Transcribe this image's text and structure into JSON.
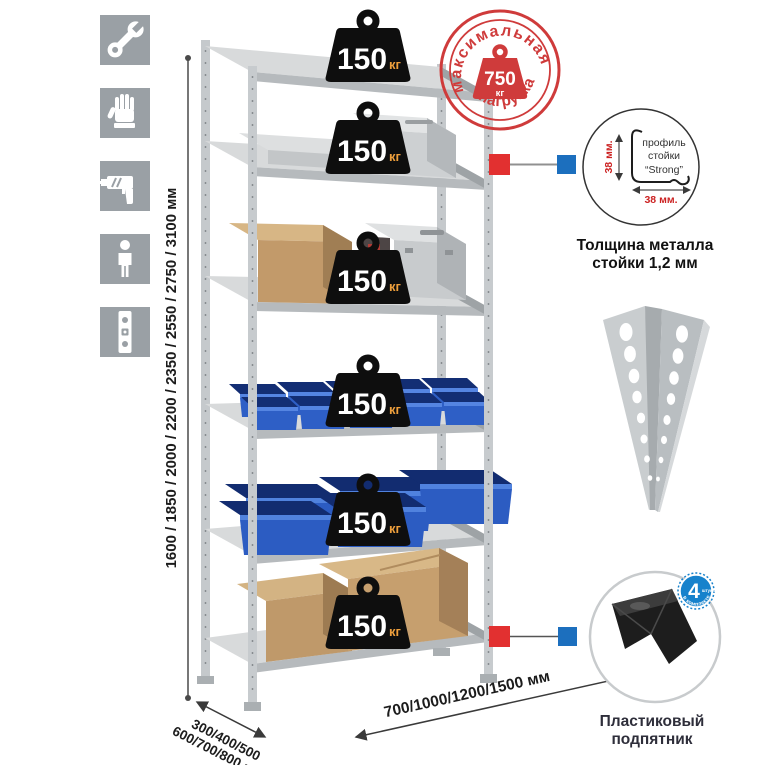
{
  "icons": [
    {
      "name": "wrench-icon"
    },
    {
      "name": "gloves-icon"
    },
    {
      "name": "drill-icon"
    },
    {
      "name": "person-icon"
    },
    {
      "name": "spirit-level-icon"
    }
  ],
  "height_dim": {
    "label": "1600 / 1850 / 2000 / 2200 / 2350 / 2550 / 2750 / 3100 мм"
  },
  "depth_dim": {
    "line1": "300/400/500",
    "line2": "600/700/800 мм"
  },
  "width_dim": {
    "label": "700/1000/1200/1500 мм"
  },
  "shelves": [
    {
      "load": "150",
      "unit": "кг"
    },
    {
      "load": "150",
      "unit": "кг"
    },
    {
      "load": "150",
      "unit": "кг"
    },
    {
      "load": "150",
      "unit": "кг"
    },
    {
      "load": "150",
      "unit": "кг"
    },
    {
      "load": "150",
      "unit": "кг"
    }
  ],
  "max_load_stamp": {
    "arc_top": "максимальная",
    "arc_bottom": "нагрузка",
    "value": "750",
    "unit": "кг"
  },
  "post_profile": {
    "label_line1": "профиль",
    "label_line2": "стойки",
    "label_line3": "“Strong”",
    "dim_height": "38 мм.",
    "dim_width": "38 мм.",
    "caption_line1": "Толщина металла",
    "caption_line2": "стойки 1,2 мм"
  },
  "foot": {
    "badge_value": "4",
    "badge_note": "штуки",
    "badge_arc": "в комплекте",
    "caption_line1": "Пластиковый",
    "caption_line2": "подпятник"
  },
  "colors": {
    "stamp_red": "#cf3b3b",
    "marker_red": "#e23030",
    "marker_blue": "#1c6fbe",
    "bin_blue": "#2e5fc6",
    "weight_badge_black": "#0e0e0e",
    "kg_orange": "#ee9f3c",
    "icon_gray": "#9aa0a5",
    "metal_light": "#d8dadb",
    "cardboard": "#c29a6a"
  }
}
